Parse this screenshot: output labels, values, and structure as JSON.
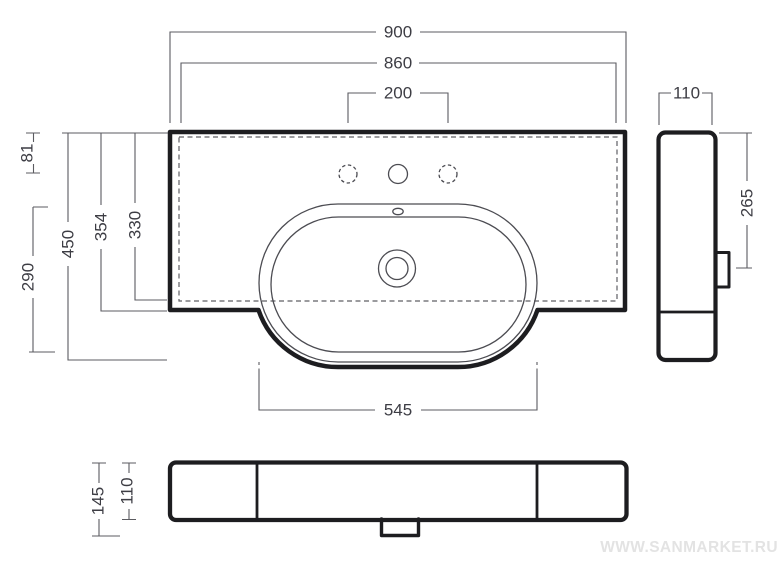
{
  "top_view": {
    "overall_width": "900",
    "mounting_width": "860",
    "tap_hole_spacing": "200",
    "top_to_tap_holes": "81",
    "overall_depth": "450",
    "depth_to_front_edge": "354",
    "depth_to_hidden_edge": "330",
    "bowl_depth": "290",
    "bowl_front_width": "545"
  },
  "side_view": {
    "thickness": "110",
    "top_to_outlet": "265"
  },
  "front_view": {
    "overall_height": "145",
    "apron_height": "110"
  },
  "watermark": "WWW.SANMARKET.RU"
}
